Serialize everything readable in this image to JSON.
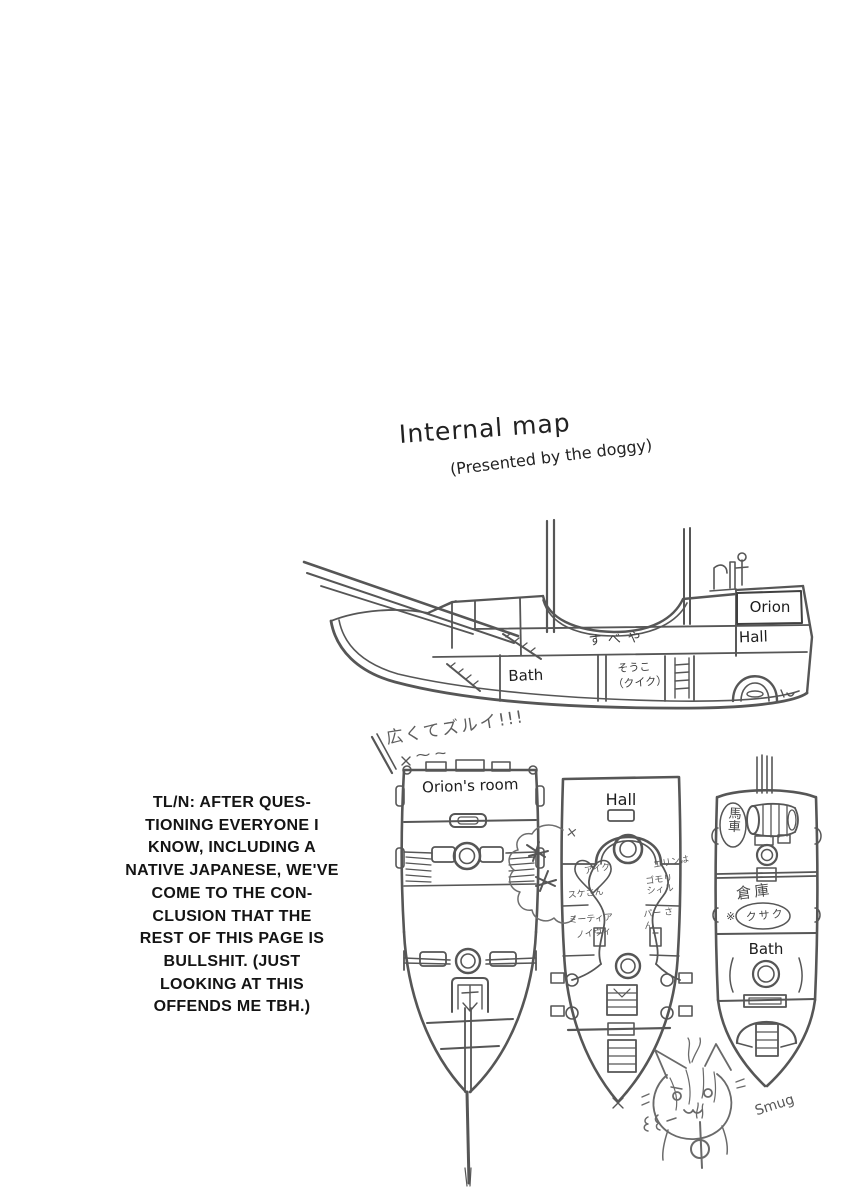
{
  "colors": {
    "paper": "#ffffff",
    "ink": "#565656",
    "text_ink": "#1d1d1d"
  },
  "title": {
    "main": "Internal map",
    "credit": "(Presented by the doggy)"
  },
  "complaint_jp": "広くてズルイ!!!",
  "side_view": {
    "orion": "Orion",
    "hall": "Hall",
    "bath": "Bath",
    "cabin_jp": "すべや",
    "storage_jp": "そうこ",
    "storage_note_jp": "（クイク）"
  },
  "tl_note": {
    "lines": [
      "TL/N: AFTER QUES-",
      "TIONING EVERYONE I",
      "KNOW, INCLUDING A",
      "NATIVE JAPANESE, WE'VE",
      "COME TO THE CON-",
      "CLUSION THAT THE",
      "REST OF THIS PAGE IS",
      "BULLSHIT. (JUST",
      "LOOKING AT THIS",
      "OFFENDS ME TBH.)"
    ]
  },
  "deck_plans": {
    "bow_plan": {
      "title": "Orion's room"
    },
    "mid_plan": {
      "title": "Hall",
      "crossout": "×",
      "scribbles": [
        "アイク",
        "スケさん",
        "ミーティア",
        "ノイヴィ",
        "エリンは",
        "ゴモリ シィル",
        "パー さん"
      ]
    },
    "stern_plan": {
      "cart_jp": "馬車",
      "storage_jp": "倉庫",
      "storage_ref_jp": "※",
      "storage_note_jp": "クサク",
      "bath": "Bath"
    }
  },
  "mascot": {
    "caption": "Smug"
  }
}
